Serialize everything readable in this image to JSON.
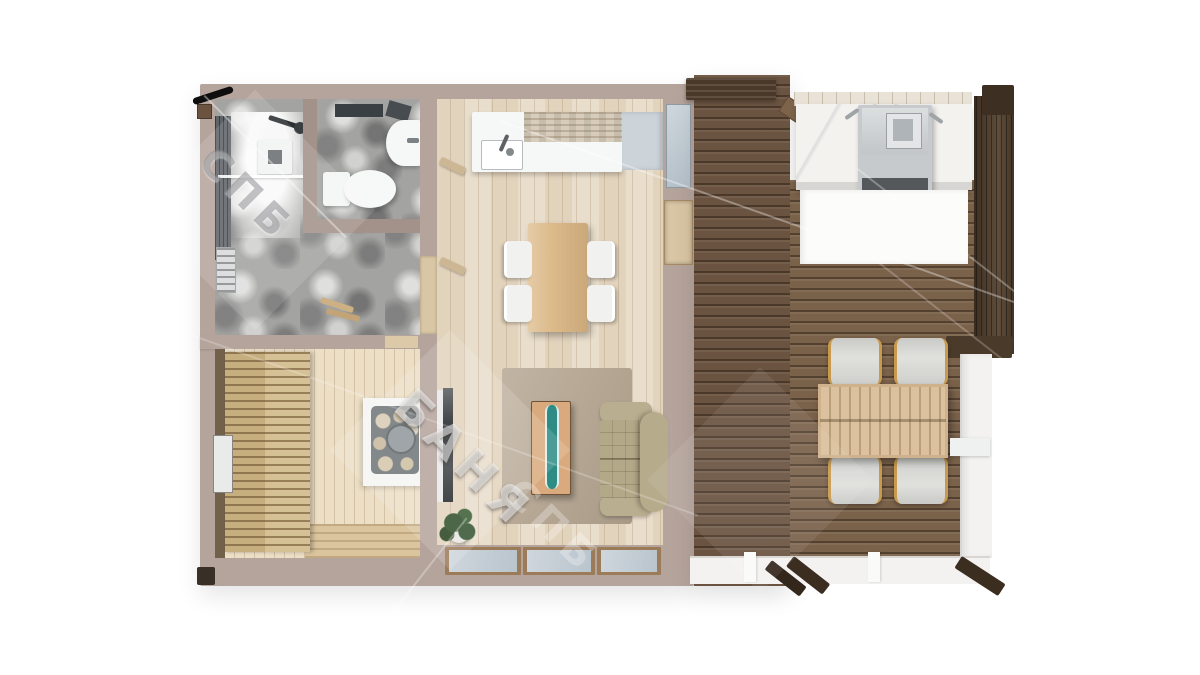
{
  "watermark": {
    "primary_text": "БАНЯ",
    "secondary_text": "СПБ",
    "tertiary_text": "СПБ"
  },
  "palette": {
    "background": "#ffffff",
    "wall": "#b5a49c",
    "wall_dark": "#a3928a",
    "stone": "#a3a3a1",
    "interior_wood": "#e7dac6",
    "sauna_wood": "#ecdfc6",
    "bench_wood": "#d6c096",
    "deck_wood": "#7a614a",
    "deck_dark": "#6a5340",
    "beam_dark": "#4a3829",
    "slat_wall": "#55422f",
    "marble": "#f3f2ef",
    "grill": "#c6cacc",
    "glass": "#c7d0d7",
    "white_trim": "#f3f2f0",
    "sofa": "#b3a887",
    "rug": "#b7a895",
    "dining_table": "#dcba8a",
    "coffee_wood": "#d9aa7e",
    "epoxy": "#2e8c85",
    "outdoor_table": "#dbc19d",
    "chair_fabric": "#e0e0dd",
    "chair_gold": "#c79a4e",
    "plant": "#2f4d2a",
    "dark_post": "#35291e"
  }
}
